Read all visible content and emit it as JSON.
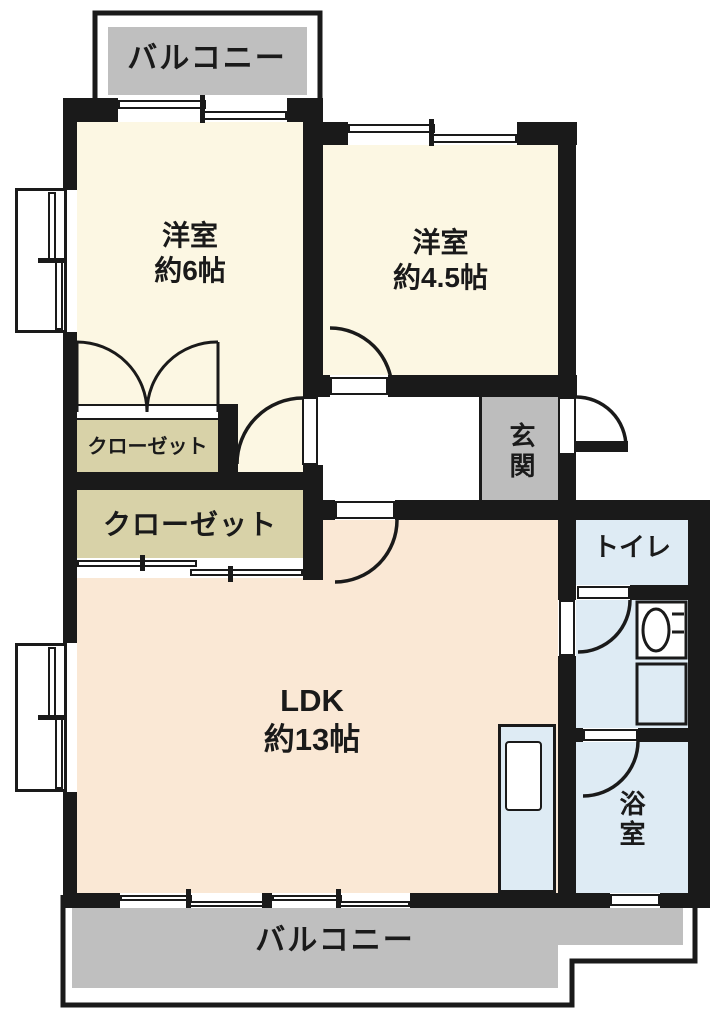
{
  "balconies": {
    "top": "バルコニー",
    "bottom": "バルコニー"
  },
  "rooms": {
    "western1": {
      "label": "洋室",
      "area": "約6帖"
    },
    "western2": {
      "label": "洋室",
      "area": "約4.5帖"
    },
    "ldk": {
      "label": "LDK",
      "area": "約13帖"
    },
    "closet_small": {
      "label": "クローゼット"
    },
    "closet_large": {
      "label": "クローゼット"
    },
    "entrance": {
      "label": "玄関"
    },
    "toilet": {
      "label": "トイレ"
    },
    "bathroom": {
      "label": "浴室"
    }
  },
  "colors": {
    "wall": "#1a1a1a",
    "room_floor": "#fcf7e3",
    "ldk_floor": "#fae8d5",
    "closet": "#d8d2a8",
    "wet_area": "#deebf4",
    "balcony": "#bfbfbf",
    "entrance_floor": "#bdbdbd"
  }
}
